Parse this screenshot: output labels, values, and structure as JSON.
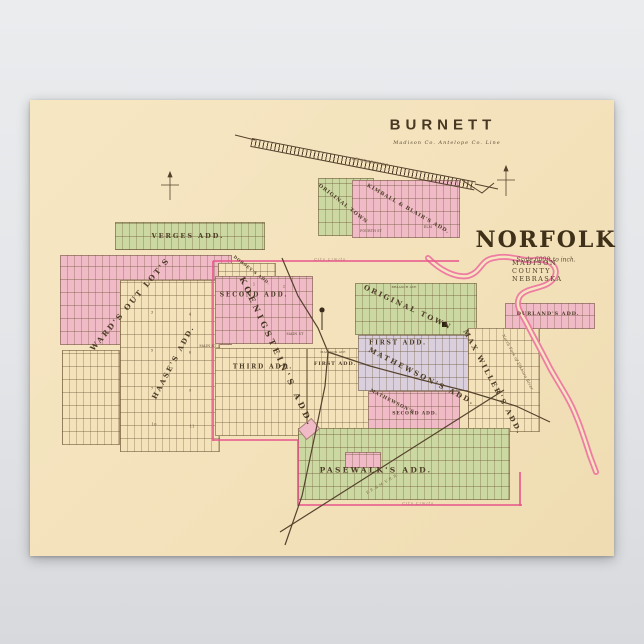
{
  "poster": {
    "titles": {
      "burnett_title": "BURNETT",
      "burnett_subtitle": "Madison Co. Antelope Co. Line",
      "norfolk_title": "NORFOLK",
      "norfolk_scale": "Scale 600ft to inch.",
      "norfolk_county": "MADISON COUNTY NEBRASKA"
    },
    "colors": {
      "paper": "#f3e1ba",
      "area_green": "#ccd8a1",
      "area_pink": "#f0bac7",
      "area_lavender": "#dad0dd",
      "boundary_pink": "#e8548b",
      "river_pink": "#ee7ca3",
      "ink": "#4e3d27",
      "background_gray": "#e3e5e8"
    },
    "map_labels": [
      {
        "text": "ORIGINAL TOWN",
        "x": 313,
        "y": 104,
        "rot": 38,
        "fs": 5,
        "cls": "add-sm"
      },
      {
        "text": "KIMBALL & BLAIR'S ADD.",
        "x": 378,
        "y": 109,
        "rot": 30,
        "fs": 5,
        "cls": "add-sm"
      },
      {
        "text": "FOURTH ST",
        "x": 341,
        "y": 131,
        "rot": 0,
        "fs": 3.2,
        "cls": "tiny"
      },
      {
        "text": "ELM",
        "x": 398,
        "y": 127,
        "rot": 0,
        "fs": 3.2,
        "cls": "tiny"
      },
      {
        "text": "DEPOT GROUNDS",
        "x": 340,
        "y": 62,
        "rot": 11,
        "fs": 3.6,
        "cls": "ital"
      },
      {
        "text": "VERGES ADD.",
        "x": 158,
        "y": 136,
        "rot": 0,
        "fs": 6.5,
        "cls": ""
      },
      {
        "text": "WARD'S OUT LOT'S",
        "x": 100,
        "y": 204,
        "rot": -50,
        "fs": 7.5,
        "cls": ""
      },
      {
        "text": "HAASE'S ADD.",
        "x": 143,
        "y": 262,
        "rot": -62,
        "fs": 7,
        "cls": ""
      },
      {
        "text": "DORSEY'S ADD.",
        "x": 222,
        "y": 170,
        "rot": 38,
        "fs": 4,
        "cls": "add-sm"
      },
      {
        "text": "SECOND ADD.",
        "x": 224,
        "y": 195,
        "rot": 0,
        "fs": 6,
        "cls": ""
      },
      {
        "text": "KOENIGSTEIN'S ADD.",
        "x": 247,
        "y": 252,
        "rot": 65,
        "fs": 8,
        "cls": "add-big"
      },
      {
        "text": "MAIN ST",
        "x": 178,
        "y": 246,
        "rot": 0,
        "fs": 3.4,
        "cls": "tiny"
      },
      {
        "text": "MAIN ST",
        "x": 265,
        "y": 234,
        "rot": 0,
        "fs": 3.4,
        "cls": "tiny"
      },
      {
        "text": "THIRD ADD.",
        "x": 233,
        "y": 267,
        "rot": 0,
        "fs": 6,
        "cls": ""
      },
      {
        "text": "FIRST ADD.",
        "x": 305,
        "y": 264,
        "rot": 0,
        "fs": 5,
        "cls": "add-sm"
      },
      {
        "text": "MADISON AVE",
        "x": 303,
        "y": 252,
        "rot": 0,
        "fs": 3,
        "cls": "tiny"
      },
      {
        "text": "ORIGINAL TOWN",
        "x": 378,
        "y": 207,
        "rot": 25,
        "fs": 7,
        "cls": ""
      },
      {
        "text": "BRAASCH AVE",
        "x": 374,
        "y": 187,
        "rot": 0,
        "fs": 3,
        "cls": "tiny"
      },
      {
        "text": "FIRST ADD.",
        "x": 368,
        "y": 243,
        "rot": 0,
        "fs": 6,
        "cls": ""
      },
      {
        "text": "MATHEWSON'S ADD.",
        "x": 392,
        "y": 276,
        "rot": 27,
        "fs": 7,
        "cls": ""
      },
      {
        "text": "MATHEWSON'S",
        "x": 362,
        "y": 302,
        "rot": 27,
        "fs": 4.5,
        "cls": "add-sm"
      },
      {
        "text": "SECOND ADD.",
        "x": 385,
        "y": 314,
        "rot": 0,
        "fs": 4.5,
        "cls": "add-sm"
      },
      {
        "text": "MAX WILLER'S ADD.",
        "x": 463,
        "y": 282,
        "rot": 62,
        "fs": 7,
        "cls": ""
      },
      {
        "text": "DURLAND'S ADD.",
        "x": 518,
        "y": 214,
        "rot": 0,
        "fs": 5,
        "cls": "add-sm"
      },
      {
        "text": "PASEWALK'S ADD.",
        "x": 346,
        "y": 370,
        "rot": 0,
        "fs": 7.5,
        "cls": ""
      },
      {
        "text": "City Limits",
        "x": 300,
        "y": 159,
        "rot": 0,
        "fs": 4,
        "cls": "city"
      },
      {
        "text": "City Limits",
        "x": 388,
        "y": 403,
        "rot": 0,
        "fs": 4,
        "cls": "city"
      },
      {
        "text": "North Fork of Elkhorn River",
        "x": 488,
        "y": 262,
        "rot": 62,
        "fs": 4,
        "cls": "ital"
      },
      {
        "text": "F. E. & M. V. R. R.",
        "x": 352,
        "y": 384,
        "rot": -31,
        "fs": 3.6,
        "cls": "ital"
      },
      {
        "text": "1",
        "x": 224,
        "y": 184,
        "rot": 0,
        "fs": 4,
        "cls": "num"
      },
      {
        "text": "2",
        "x": 254,
        "y": 186,
        "rot": 0,
        "fs": 4,
        "cls": "num"
      },
      {
        "text": "3",
        "x": 122,
        "y": 212,
        "rot": 0,
        "fs": 4,
        "cls": "num"
      },
      {
        "text": "4",
        "x": 160,
        "y": 214,
        "rot": 0,
        "fs": 4,
        "cls": "num"
      },
      {
        "text": "5",
        "x": 122,
        "y": 250,
        "rot": 0,
        "fs": 4,
        "cls": "num"
      },
      {
        "text": "6",
        "x": 160,
        "y": 252,
        "rot": 0,
        "fs": 4,
        "cls": "num"
      },
      {
        "text": "7",
        "x": 122,
        "y": 288,
        "rot": 0,
        "fs": 4,
        "cls": "num"
      },
      {
        "text": "9",
        "x": 160,
        "y": 290,
        "rot": 0,
        "fs": 4,
        "cls": "num"
      },
      {
        "text": "10",
        "x": 124,
        "y": 324,
        "rot": 0,
        "fs": 4,
        "cls": "num"
      },
      {
        "text": "11",
        "x": 162,
        "y": 326,
        "rot": 0,
        "fs": 4,
        "cls": "num"
      }
    ]
  }
}
